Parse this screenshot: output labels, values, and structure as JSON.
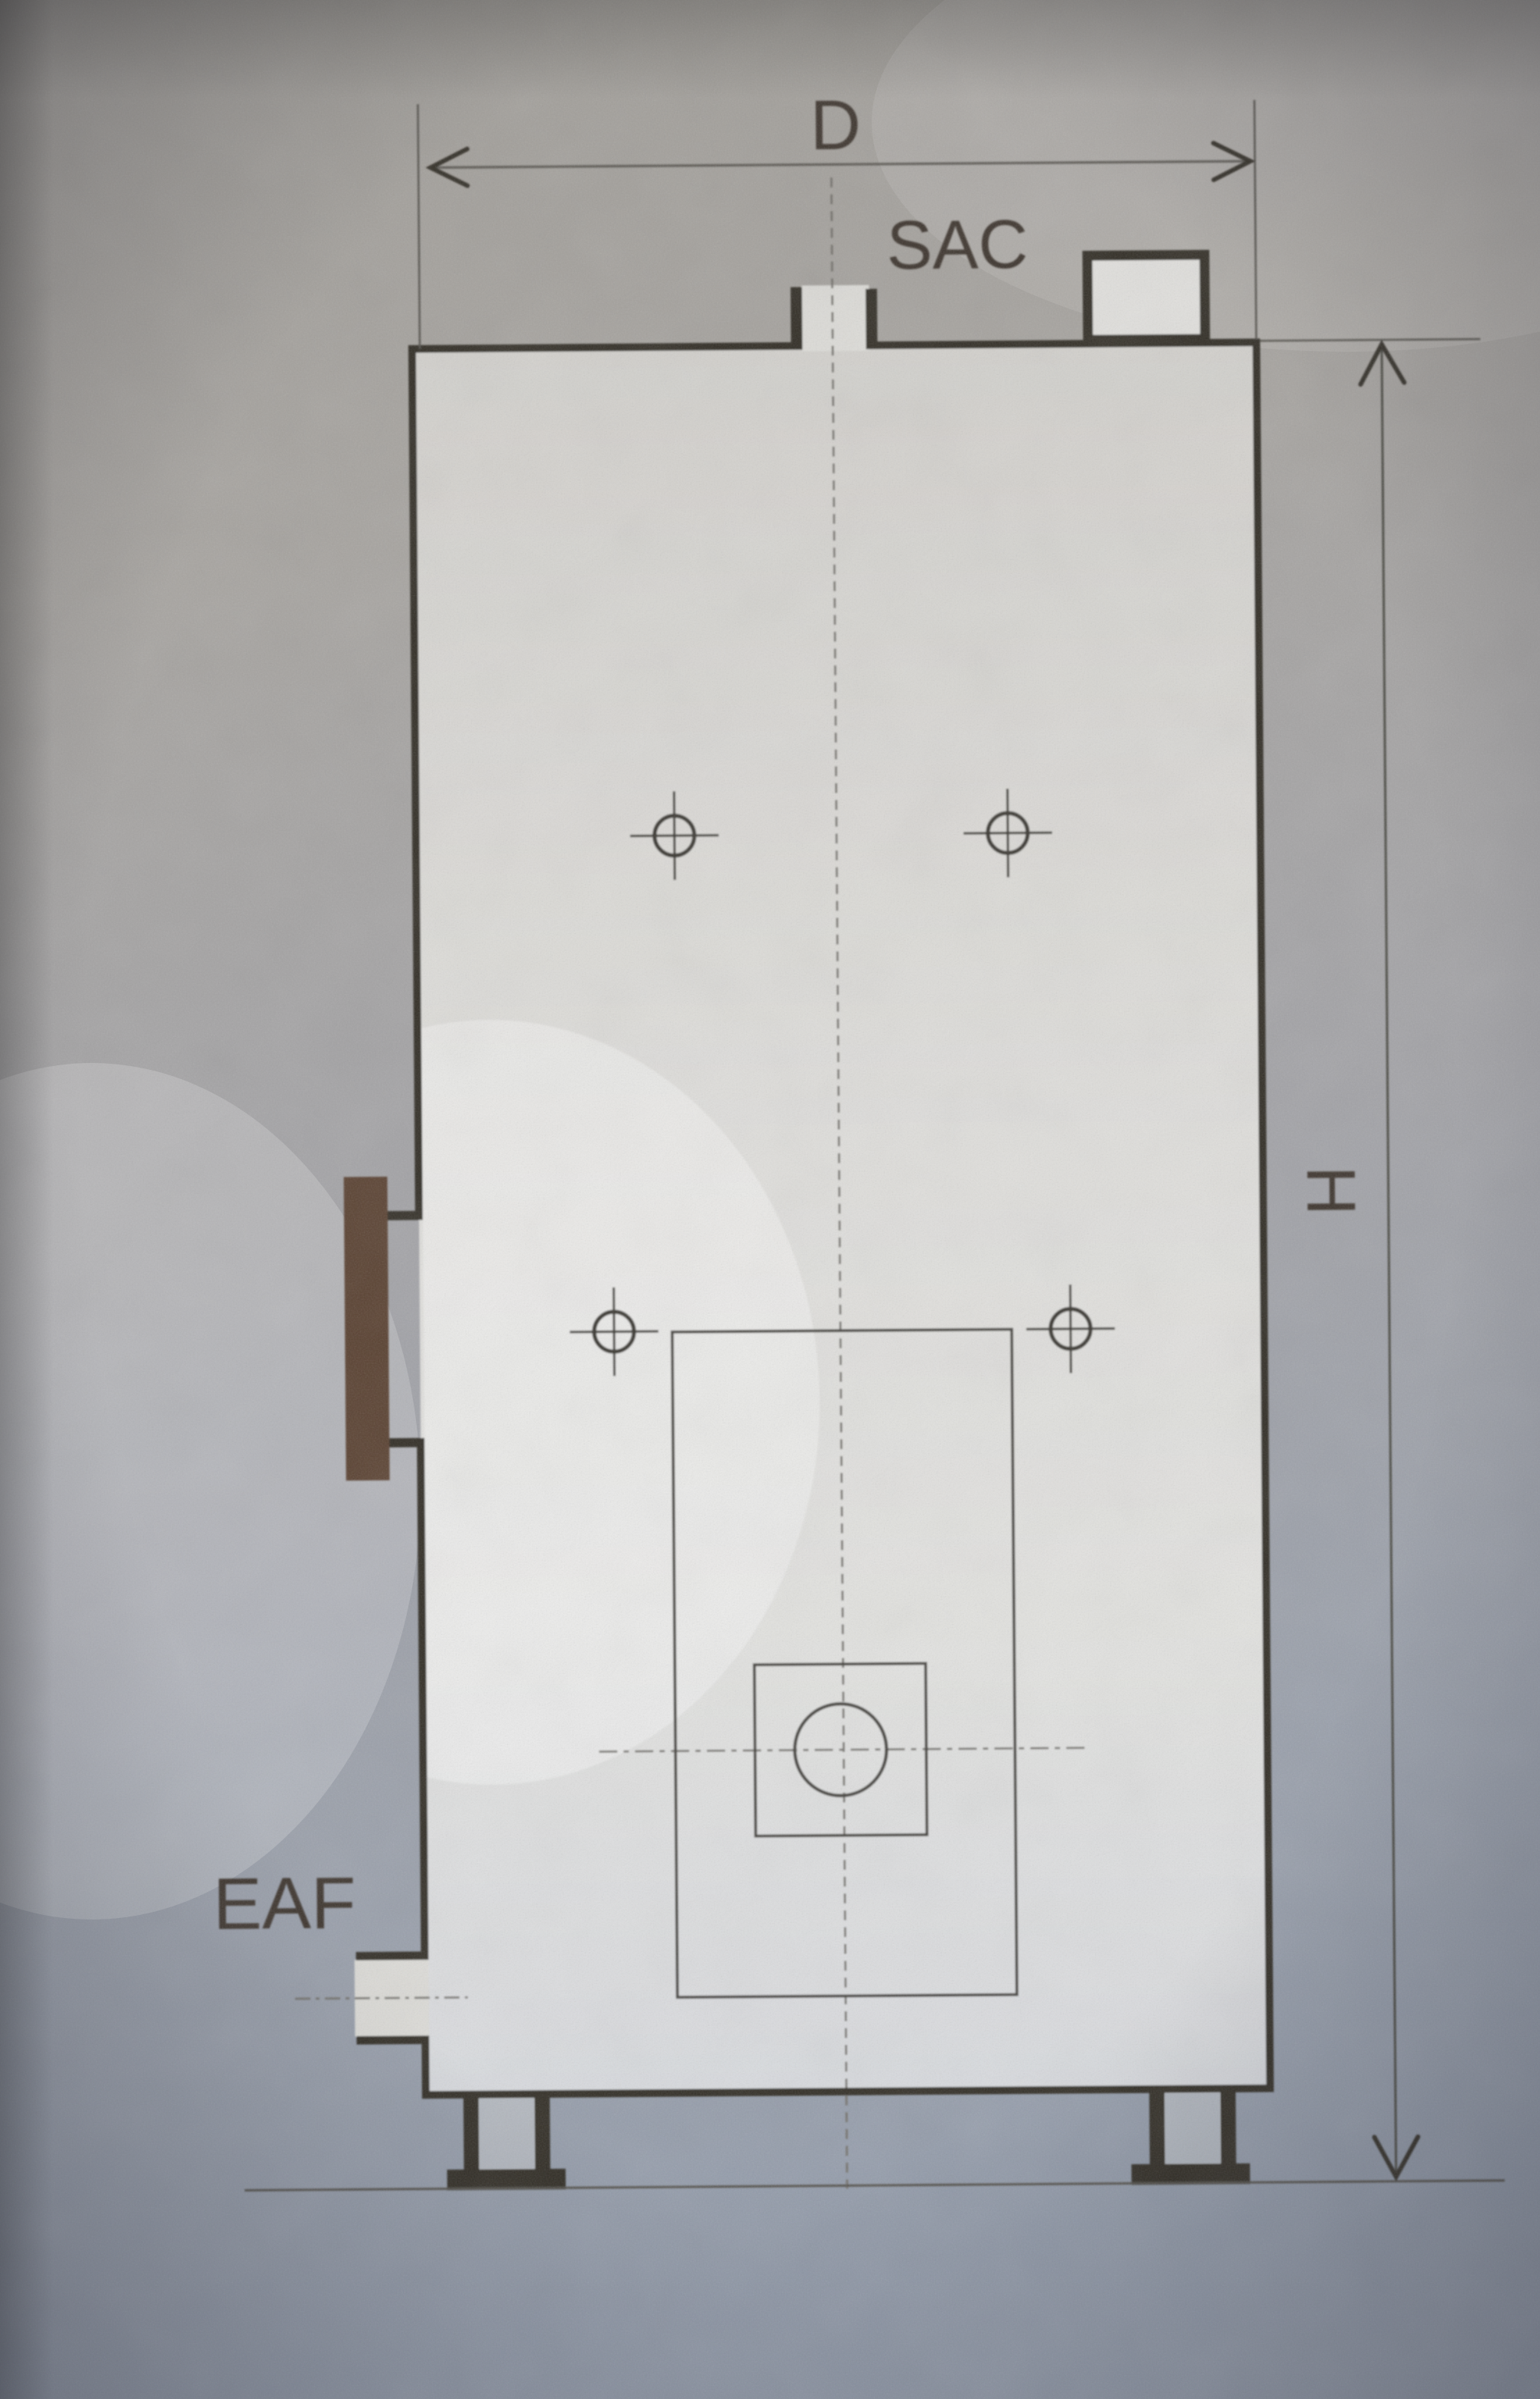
{
  "labels": {
    "width_dimension": "D",
    "flue_connection": "SAC",
    "exhaust_connection": "EAF",
    "height_dimension": "H"
  },
  "colors": {
    "paper_top": "#a5a19c",
    "paper_bottom": "#99a0ad",
    "drawing_fill": "#dedcd8",
    "outline": "#332d26",
    "thin_line": "#45433e",
    "dashed_line": "#73716c",
    "door_bar": "#5a4232",
    "label_text": "#3c362e"
  }
}
